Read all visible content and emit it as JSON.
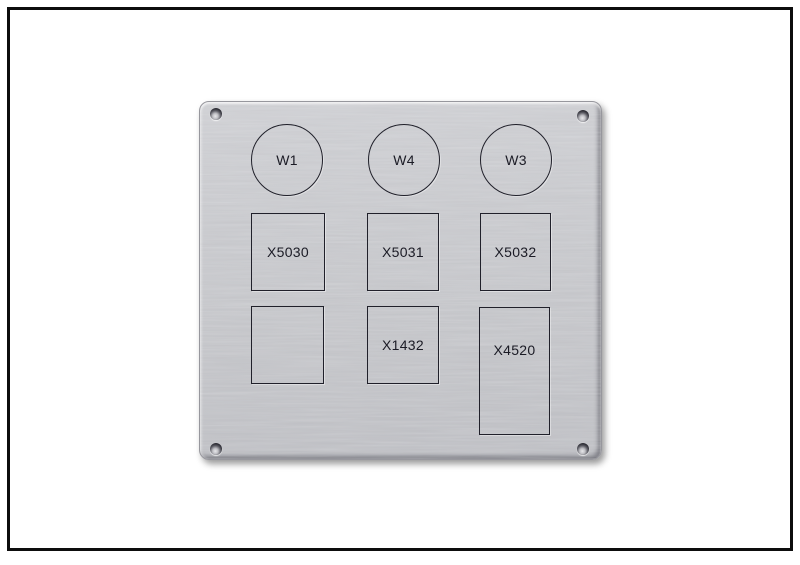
{
  "plate": {
    "circles": [
      {
        "label": "W1"
      },
      {
        "label": "W4"
      },
      {
        "label": "W3"
      }
    ],
    "rects": [
      {
        "label": "X5030"
      },
      {
        "label": "X5031"
      },
      {
        "label": "X5032"
      },
      {
        "label": ""
      },
      {
        "label": "X1432"
      },
      {
        "label": "X4520"
      }
    ],
    "colors": {
      "background": "#ffffff",
      "frame_border": "#0d0d0d",
      "plate_base": "#c6c7cb",
      "engraving": "#1b1b25"
    }
  }
}
